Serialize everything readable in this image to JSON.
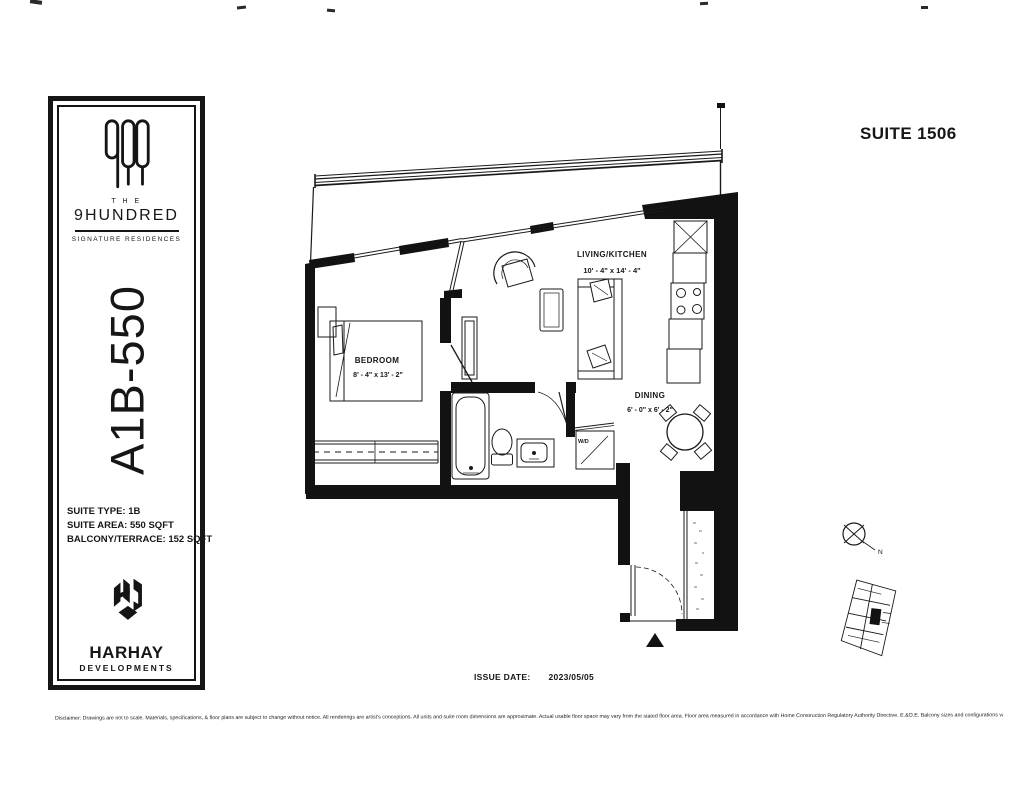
{
  "header": {
    "suite_label": "SUITE 1506"
  },
  "sidebar": {
    "brand_the": "T H E",
    "brand_name": "9HUNDRED",
    "brand_tagline": "SIGNATURE RESIDENCES",
    "plan_code": "A1B-550",
    "specs": [
      "SUITE TYPE: 1B",
      "SUITE AREA: 550 SQFT",
      "BALCONY/TERRACE: 152 SQFT"
    ],
    "developer_name": "HARHAY",
    "developer_sub": "DEVELOPMENTS"
  },
  "floorplan": {
    "rooms": [
      {
        "name": "BEDROOM",
        "dims": "8' - 4\" x 13' - 2\""
      },
      {
        "name": "LIVING/KITCHEN",
        "dims": "10' - 4\" x 14' - 4\""
      },
      {
        "name": "DINING",
        "dims": "6' - 0\" x 6' - 2\""
      }
    ],
    "washer_dryer_label": "W/D",
    "compass_label": "N"
  },
  "footer": {
    "issue_date_label": "ISSUE DATE:",
    "issue_date_value": "2023/05/05",
    "disclaimer": "Disclaimer: Drawings are not to scale. Materials, specifications, & floor plans are subject to change without notice. All renderings are artist's conceptions. All units and suite room dimensions are approximate. Actual usable floor space may vary from the stated floor area. Floor area measured in accordance with Home Construction Regulatory Authority Directive. E.&O.E. Balcony sizes and configurations vary depending on floor level locations."
  },
  "colors": {
    "ink": "#161616",
    "paper": "#ffffff"
  }
}
